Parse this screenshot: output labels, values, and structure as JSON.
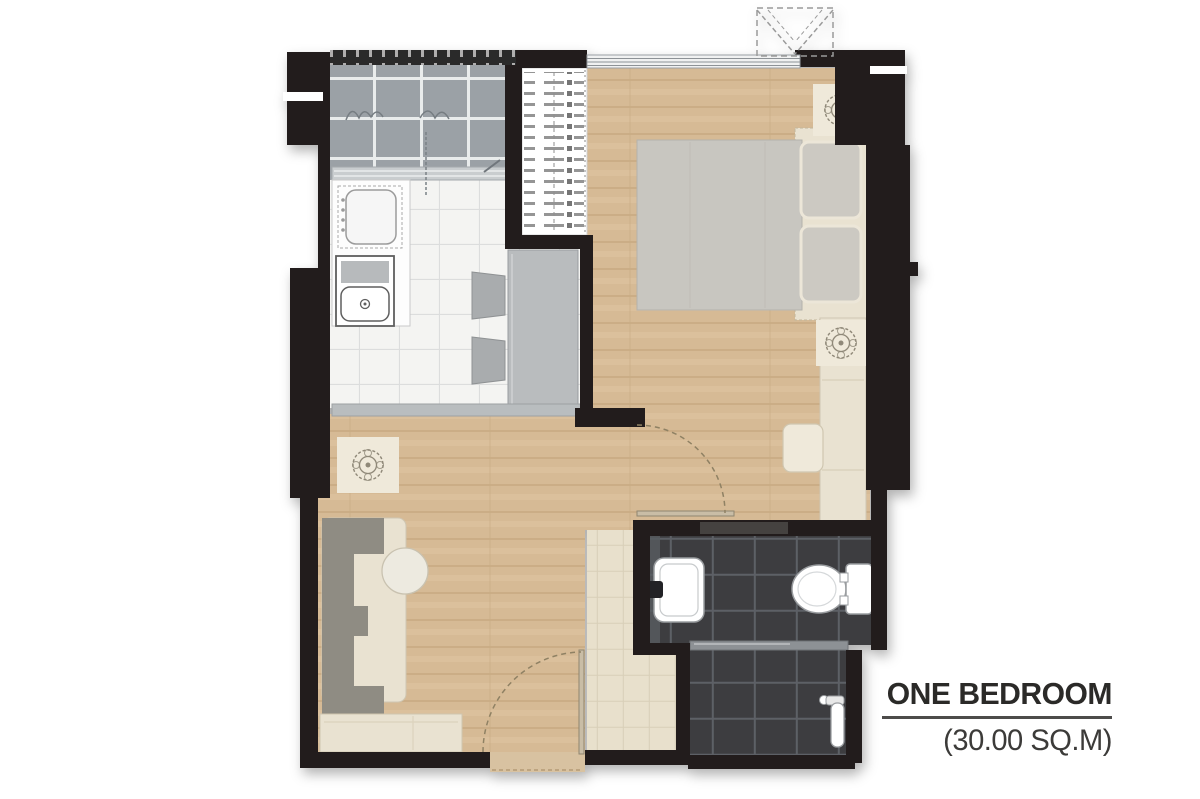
{
  "label": {
    "title": "ONE BEDROOM",
    "area": "(30.00 SQ.M)"
  },
  "palette": {
    "wall": "#211e1e",
    "wood-floor": "#d6ba95",
    "wood-plank-line": "#c9ab84",
    "kitchen-tile": "#f4f4f2",
    "balcony-tile": "#9ba1a6",
    "bathroom-tile": "#3c3c3f",
    "entry-tile": "#e8e0cc",
    "cream-furniture": "#e9e2d1",
    "gray-furniture": "#b9bcbe",
    "sofa-gray": "#8f8c83",
    "duvet-gray": "#c8c6c0",
    "fixture-white": "#ffffff",
    "label-text": "#2b2a28",
    "label-sub": "#3c3b39",
    "rule": "#4d4c4a"
  }
}
